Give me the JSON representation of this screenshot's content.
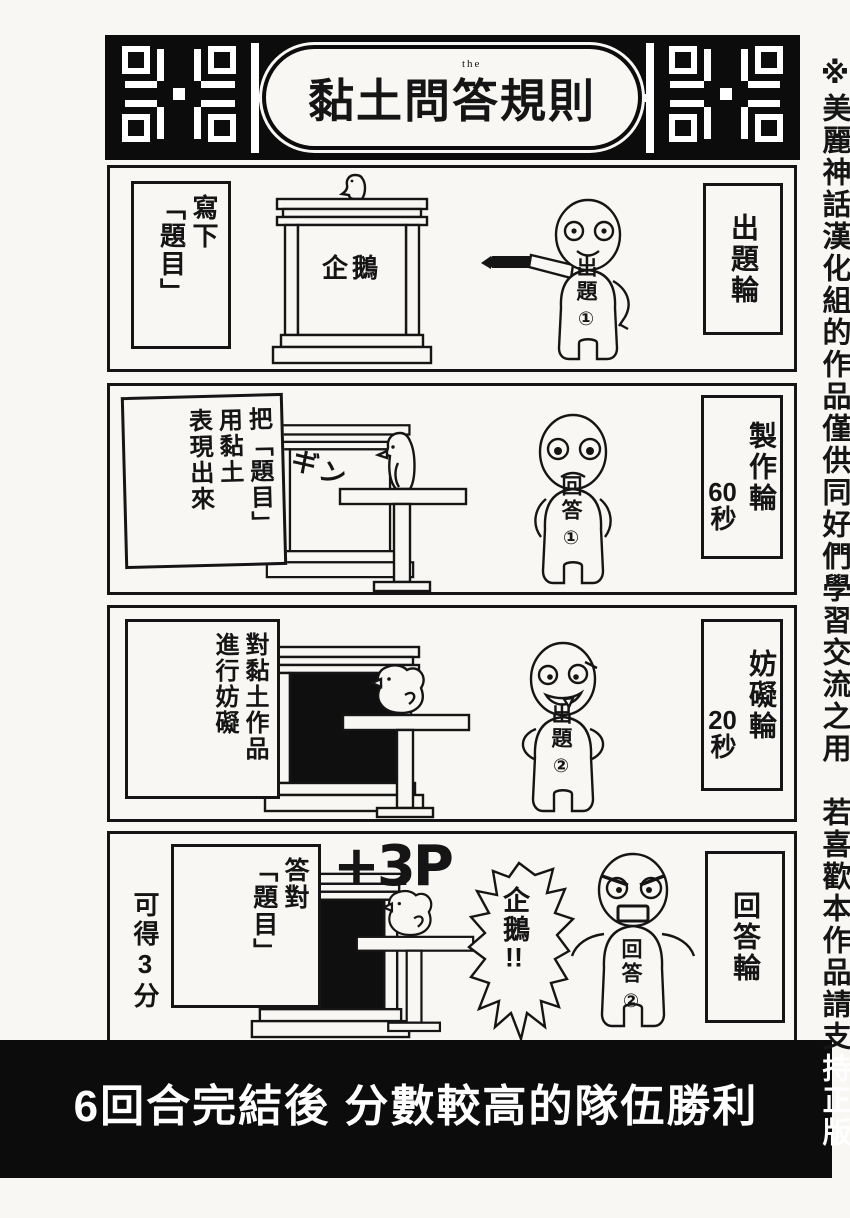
{
  "colors": {
    "ink": "#151515",
    "paper": "#f8f7f4",
    "band": "#0c0c0c"
  },
  "title_banner": {
    "title": "黏土問答規則",
    "ruby": "the"
  },
  "side_note": {
    "black_part": "※美麗神話漢化組的作品僅供同好們學習交流之用　若喜歡本作品請支",
    "white_part": "持正版"
  },
  "footer_banner": {
    "text": "6回合完結後 分數較高的隊伍勝利"
  },
  "panels": [
    {
      "caption": "寫下\n「題目」",
      "round_label": "出題輪",
      "board_text": "企鵝",
      "figure": {
        "role": "出題",
        "number": "①"
      }
    },
    {
      "caption": "把「題目」\n用黏土\n表現出來",
      "round_label": "製作輪",
      "time_value": "60",
      "time_unit": "秒",
      "sfx": "ギン",
      "figure": {
        "role": "回答",
        "number": "①"
      }
    },
    {
      "caption": "對黏土作品\n進行妨礙",
      "round_label": "妨礙輪",
      "time_value": "20",
      "time_unit": "秒",
      "figure": {
        "role": "出題",
        "number": "②"
      }
    },
    {
      "caption": "答對\n「題目」",
      "caption_extra": "可得3分",
      "round_label": "回答輪",
      "bonus": "+3P",
      "speech": {
        "text": "企鵝",
        "bang": "!!"
      },
      "figure": {
        "role": "回答",
        "number": "②"
      }
    }
  ]
}
